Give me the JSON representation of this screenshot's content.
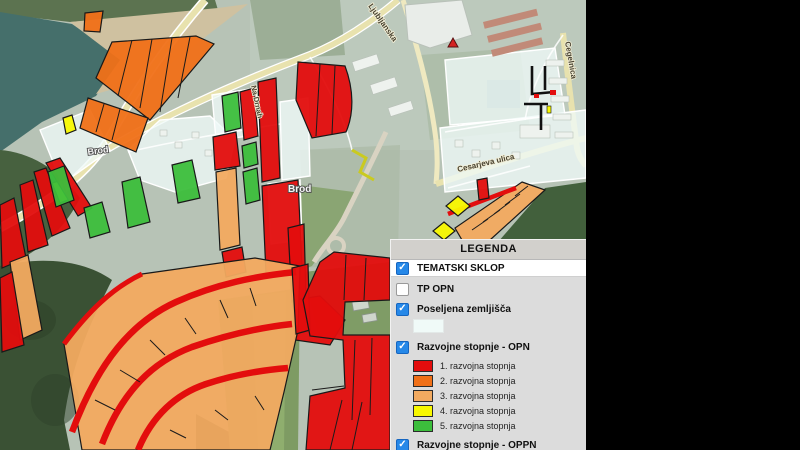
{
  "window": {
    "note": "municipal GIS map viewer with legend overlay"
  },
  "colors": {
    "stage1_red": "#e30d0d",
    "stage2_orange": "#f07018",
    "stage3_tan": "#f2aa60",
    "stage4_yellow": "#f8f800",
    "stage5_green": "#3cbe3c",
    "poseljena": "#f0faf8",
    "checkbox_blue": "#2688e8",
    "panel_bg": "#dcdcdc",
    "panel_header_bg": "#d2d0cc",
    "black_backdrop": "#000000"
  },
  "map": {
    "labels": {
      "brod_left": "Brod",
      "brod_center": "Brod",
      "cesarjeva": "Cesarjeva ulica",
      "ljubljanska": "Ljubljanska",
      "cegelnica": "Cegelnica",
      "na_drnah": "Na Drnah"
    }
  },
  "legend": {
    "title": "LEGENDA",
    "check_glyph": "✓",
    "sections": [
      {
        "label": "TEMATSKI SKLOP",
        "checked": true
      },
      {
        "label": "TP OPN",
        "checked": false
      },
      {
        "label": "Poseljena zemljišča",
        "checked": true
      },
      {
        "label": "Razvojne stopnje - OPN",
        "checked": true
      },
      {
        "label": "Razvojne stopnje - OPPN",
        "checked": true
      }
    ],
    "poseljena_swatch_color": "#f0faf8",
    "stages": [
      {
        "label": "1. razvojna stopnja",
        "color": "#e30d0d"
      },
      {
        "label": "2. razvojna stopnja",
        "color": "#f07018"
      },
      {
        "label": "3. razvojna stopnja",
        "color": "#f2aa60"
      },
      {
        "label": "4. razvojna stopnja",
        "color": "#f8f800"
      },
      {
        "label": "5. razvojna stopnja",
        "color": "#3cbe3c"
      }
    ]
  }
}
